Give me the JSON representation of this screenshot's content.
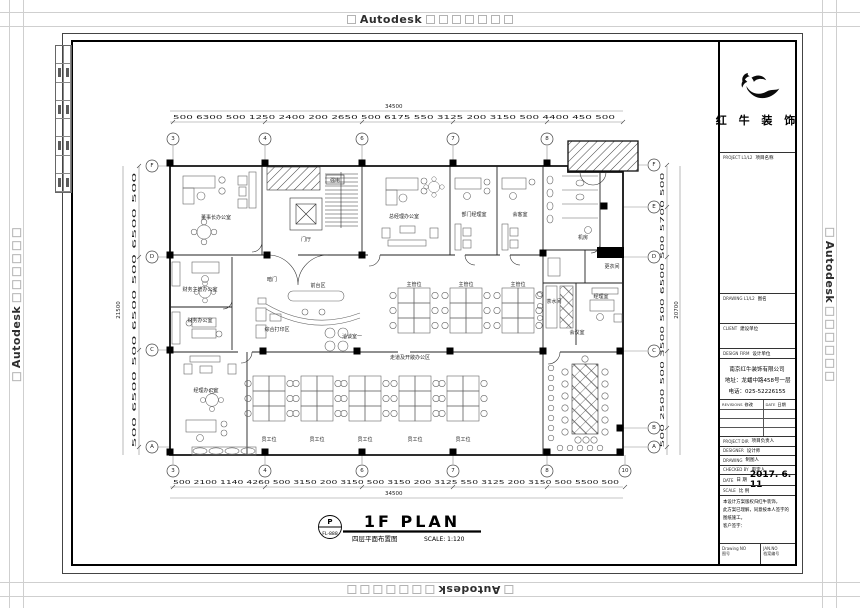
{
  "watermark": {
    "word": "Autodesk"
  },
  "plan": {
    "title": "1F PLAN",
    "subtitle": "四层平面布置图",
    "scale": "SCALE: 1:120",
    "stamp_top": "P",
    "stamp_no": "FL-888",
    "dims": {
      "top_total": "34500",
      "bottom_total": "34500",
      "left_total": "21500",
      "right_total": "20700",
      "top": [
        "500",
        "6300",
        "500",
        "1250",
        "2400",
        "200",
        "2650",
        "500",
        "6175",
        "550",
        "3125",
        "200",
        "3150",
        "500",
        "4400",
        "450",
        "500"
      ],
      "bottom": [
        "500",
        "2100",
        "1140",
        "4260",
        "500",
        "3150",
        "200",
        "3150",
        "500",
        "3150",
        "200",
        "3125",
        "550",
        "3125",
        "200",
        "3150",
        "500",
        "5500",
        "500"
      ],
      "left": [
        "500",
        "6500",
        "500",
        "6500",
        "500",
        "6500",
        "500"
      ],
      "right": [
        "500",
        "2500",
        "500",
        "3500",
        "500",
        "6500",
        "500",
        "5700",
        "500"
      ]
    },
    "grid": {
      "top": [
        "3",
        "4",
        "6",
        "7",
        "8"
      ],
      "bottom": [
        "3",
        "4",
        "6",
        "7",
        "8",
        "10"
      ],
      "left": [
        "F",
        "D",
        "C",
        "A"
      ],
      "right": [
        "F",
        "E",
        "D",
        "C",
        "B",
        "A"
      ]
    },
    "rooms": {
      "chairman": "董事长办公室",
      "finance_mgr": "财务主管办公室",
      "finance": "财务办公室",
      "manager": "经理办公室",
      "gm": "总经理办公室",
      "dept_mgr": "部门经理室",
      "guest": "会客室",
      "lobby": "门厅",
      "hidden_door": "暗门",
      "front_desk": "前台区",
      "print_zone": "综合打印区",
      "talk_room": "洽谈室一",
      "corridor": "走道及开敞办公区",
      "supervisor": "主管位",
      "staff": "员工位",
      "pantry": "茶水间",
      "manager2": "经理室",
      "meeting": "会议室",
      "server": "机房",
      "locker": "更衣间",
      "power": "强电"
    }
  },
  "titleblock": {
    "brand": "红 牛 装 饰",
    "project_en": "PROJECT L1/L2",
    "project_cn": "项目名称",
    "drawing_en": "DRAWING L1/L2",
    "drawing_cn": "图名",
    "client_en": "CLIENT",
    "client_cn": "建设单位",
    "firm_en": "DESIGN FIRM",
    "firm_cn": "设计单位",
    "company": "南京红牛装饰有限公司",
    "address": "地址：龙蟠中路458号一层",
    "phone": "电话：025-52226155",
    "rev_en": "REVISIONS",
    "rev_cn": "修改",
    "revdate_en": "DATE",
    "revdate_cn": "日期",
    "people": [
      {
        "en": "PROJECT DIR",
        "cn": "项目负责人"
      },
      {
        "en": "DESIGNER",
        "cn": "设计师"
      },
      {
        "en": "DRAWING",
        "cn": "制图人"
      },
      {
        "en": "CHECKED BY",
        "cn": "审定人"
      }
    ],
    "date_en": "DATE",
    "date_cn": "日 期",
    "date_value": "2017. 6. 11",
    "scale_en": "SCALE",
    "scale_cn": "比 例",
    "notes": [
      "本设计方案版权归红牛装饰，",
      "此方案已理解，同意按本人签字的图纸施工。",
      "客户签字："
    ],
    "footer_left_en": "Drawing NO",
    "footer_left_cn": "图号",
    "footer_right_en": "JAN.NO",
    "footer_right_cn": "档案编号"
  }
}
